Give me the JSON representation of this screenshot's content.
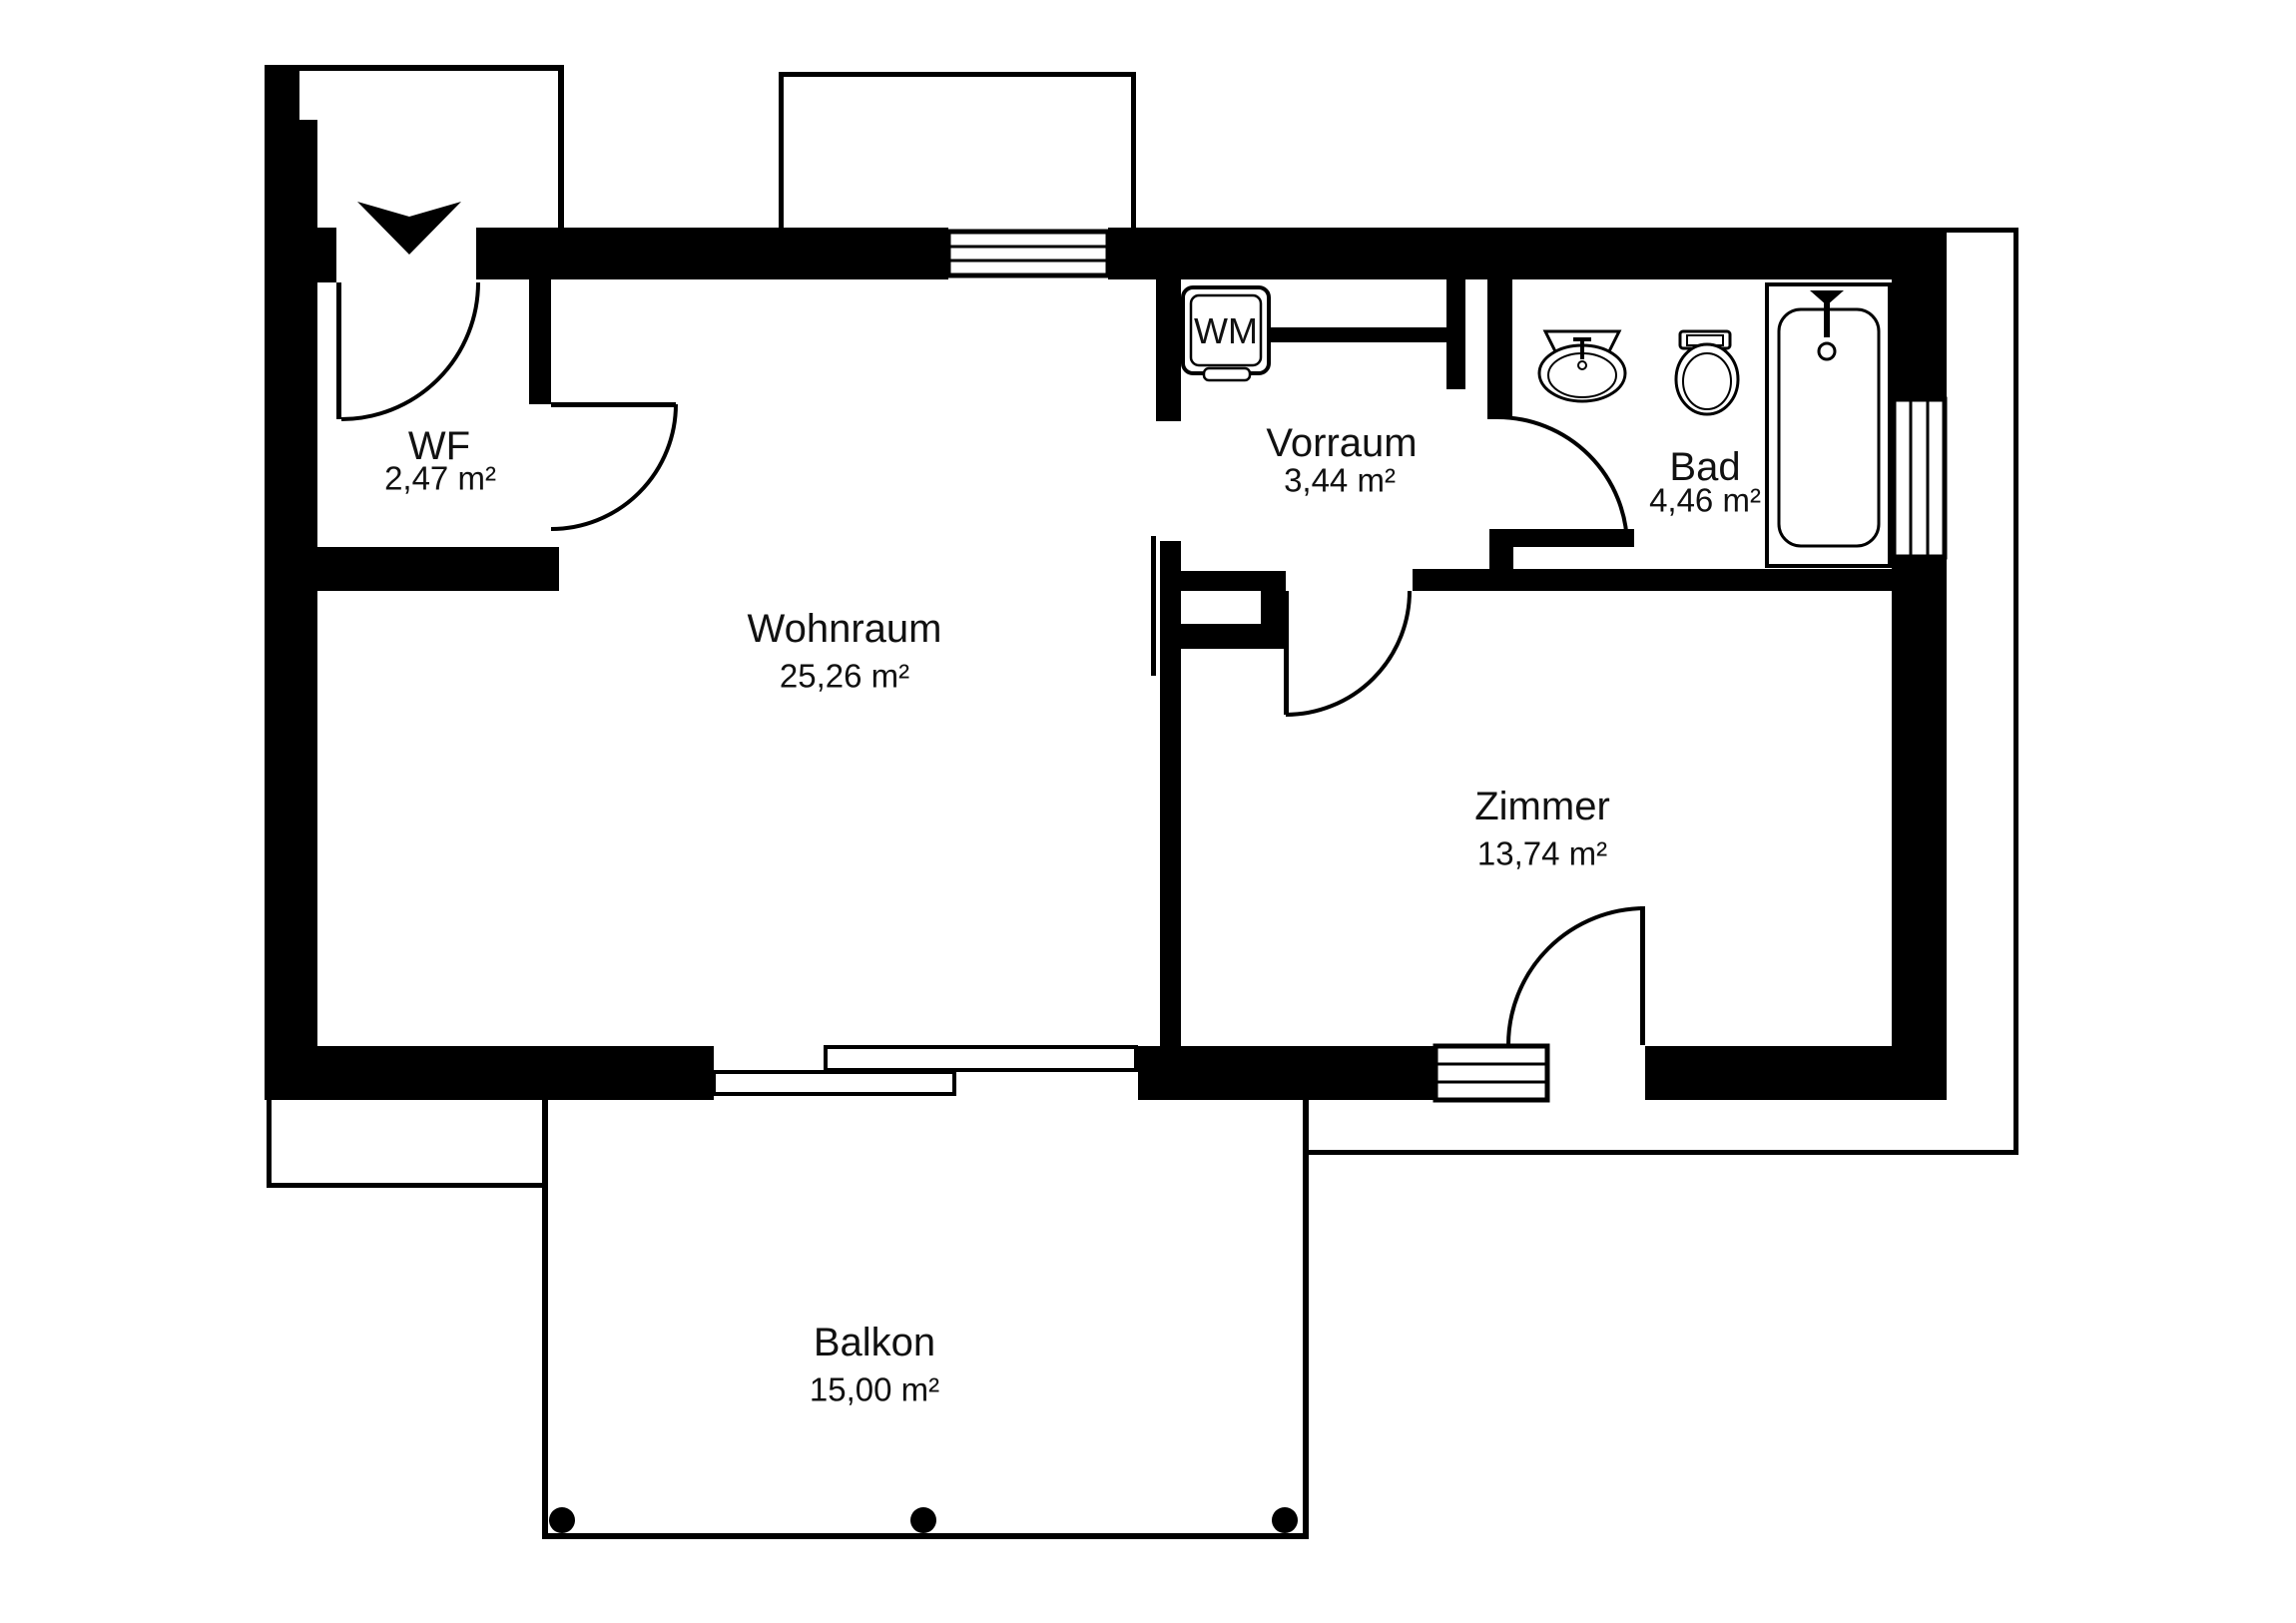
{
  "colors": {
    "wall": "#000000",
    "background": "#ffffff",
    "text": "#111111"
  },
  "rooms": [
    {
      "id": "wf",
      "name": "WF",
      "area": "2,47 m²"
    },
    {
      "id": "wohnraum",
      "name": "Wohnraum",
      "area": "25,26 m²"
    },
    {
      "id": "vorraum",
      "name": "Vorraum",
      "area": "3,44 m²"
    },
    {
      "id": "bad",
      "name": "Bad",
      "area": "4,46 m²"
    },
    {
      "id": "zimmer",
      "name": "Zimmer",
      "area": "13,74 m²"
    },
    {
      "id": "balkon",
      "name": "Balkon",
      "area": "15,00 m²"
    }
  ],
  "appliances": {
    "washing_machine_label": "WM"
  },
  "fixtures": [
    "entrance-arrow",
    "washing-machine",
    "sink",
    "toilet",
    "bathtub",
    "balcony-posts"
  ]
}
